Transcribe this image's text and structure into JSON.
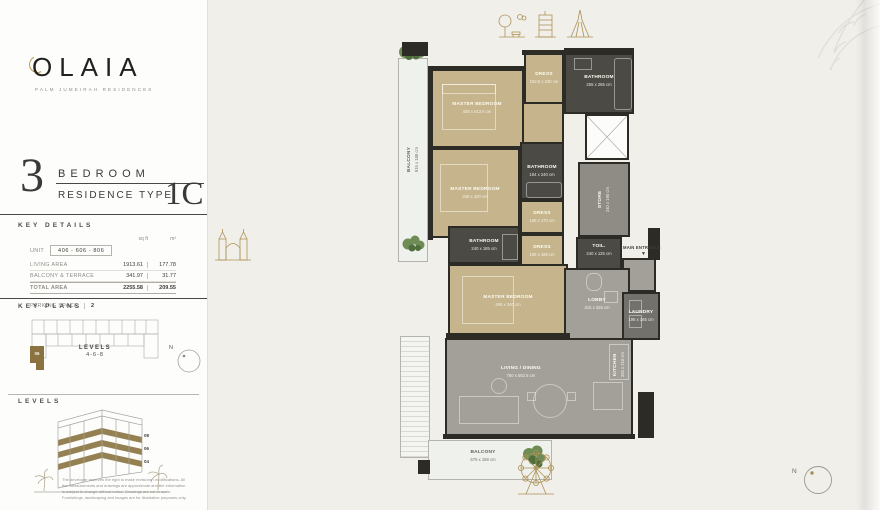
{
  "brand": {
    "name": "OLAIA",
    "tagline": "PALM JUMEIRAH RESIDENCES"
  },
  "title": {
    "big_number": "3",
    "bedroom_label": "BEDROOM",
    "residence_label": "RESIDENCE TYPE",
    "type_code": "1C"
  },
  "key_details": {
    "heading": "KEY DETAILS",
    "units": {
      "sqft": "sq ft",
      "sqm": "m²"
    },
    "unit_row": {
      "label": "UNIT",
      "value": "406 - 606 - 806"
    },
    "rows": [
      {
        "label": "LIVING AREA",
        "sqft": "1913.61",
        "sqm": "177.78"
      },
      {
        "label": "BALCONY & TERRACE",
        "sqft": "341.97",
        "sqm": "31.77"
      },
      {
        "label": "TOTAL AREA",
        "sqft": "2255.58",
        "sqm": "209.55"
      }
    ],
    "parking": {
      "label": "PARKING SPACE",
      "value": "2"
    }
  },
  "key_plans": {
    "heading": "KEY PLANS",
    "levels_label": "LEVELS",
    "levels_value": "4-6-8",
    "highlight_unit": "06",
    "north_label": "N"
  },
  "levels_section": {
    "heading": "LEVELS",
    "floor_labels": [
      "08",
      "06",
      "04"
    ],
    "disclaimer": "The developer reserves the right to make revisions / modifications. All the measurements and drawings are approximate and the information is subject to change without notice. Drawings are not to scale. Furnishings, landscaping and images are for illustrative purposes only."
  },
  "floor_plan": {
    "north_label": "N",
    "main_entrance_label": "MAIN ENTRANCE",
    "rooms": {
      "master1": {
        "name": "MASTER BEDROOM",
        "dims": "408 x 513.5 cm"
      },
      "dress1": {
        "name": "DRESS",
        "dims": "192.5 x 230 cm"
      },
      "bath1": {
        "name": "BATHROOM",
        "dims": "255 x 265 cm"
      },
      "bath2": {
        "name": "BATHROOM",
        "dims": "184 x 240 cm"
      },
      "master2": {
        "name": "MASTER BEDROOM",
        "dims": "348 x 420 cm"
      },
      "dress2": {
        "name": "DRESS",
        "dims": "165 x 170 cm"
      },
      "store": {
        "name": "STORE",
        "dims": "240 x 190 cm"
      },
      "toilet": {
        "name": "TOIL.",
        "dims": "240 x 125 cm"
      },
      "bath3": {
        "name": "BATHROOM",
        "dims": "240 x 185 cm"
      },
      "dress3": {
        "name": "DRESS",
        "dims": "195 x 185 cm"
      },
      "master3": {
        "name": "MASTER BEDROOM",
        "dims": "455 x 340 cm"
      },
      "lobby": {
        "name": "LOBBY",
        "dims": "315 x 325 cm"
      },
      "laundry": {
        "name": "LAUNDRY",
        "dims": "195 x 165 cm"
      },
      "living": {
        "name": "LIVING / DINING",
        "dims": "760 x 582.5 cm"
      },
      "kitchen": {
        "name": "KITCHEN",
        "dims": "345 x 218 cm"
      },
      "balcony_left": {
        "name": "BALCONY",
        "dims": "915 x 188 cm"
      },
      "balcony_bottom": {
        "name": "BALCONY",
        "dims": "675 x 158 cm"
      }
    }
  },
  "colors": {
    "accent_gold": "#ae9257",
    "bedroom_tan": "#c5b48c",
    "wall_dark": "#2c2b26",
    "living_gray": "#a3a09a",
    "panel_bg": "#f1efea"
  }
}
